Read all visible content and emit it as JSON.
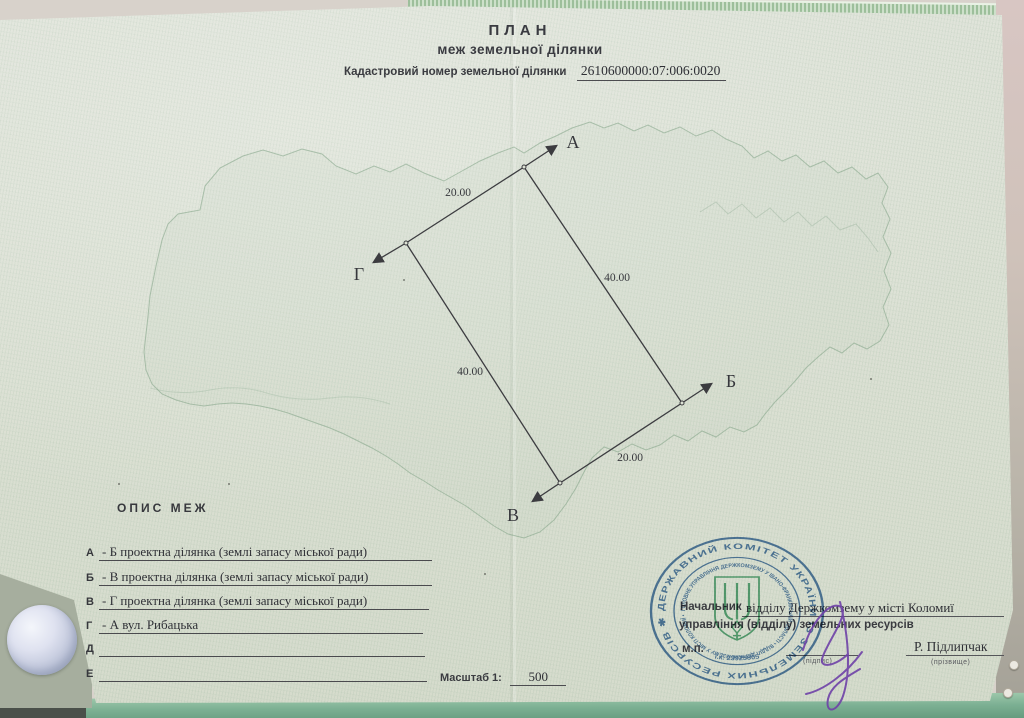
{
  "title": {
    "line1": "ПЛАН",
    "line2": "меж земельної ділянки"
  },
  "cadastral": {
    "label": "Кадастровий номер земельної ділянки",
    "number": "2610600000:07:006:0020"
  },
  "diagram": {
    "corner_a": "А",
    "corner_b": "Б",
    "corner_v": "В",
    "corner_g": "Г",
    "len_ga": "20.00",
    "len_ab": "40.00",
    "len_gv": "40.00",
    "len_vb": "20.00"
  },
  "description": {
    "heading": "ОПИС МЕЖ",
    "rows": [
      {
        "letter": "А",
        "text": "- Б проектна ділянка (землі запасу міської ради)"
      },
      {
        "letter": "Б",
        "text": "- В проектна ділянка (землі запасу міської ради)"
      },
      {
        "letter": "В",
        "text": "- Г проектна ділянка (землі запасу міської ради)"
      },
      {
        "letter": "Г",
        "text": "- А вул. Рибацька"
      },
      {
        "letter": "Д",
        "text": ""
      },
      {
        "letter": "Е",
        "text": ""
      }
    ]
  },
  "scale": {
    "label": "Масштаб 1:",
    "value": "500"
  },
  "approval": {
    "position_label": "Начальник",
    "position_filled": "відділу Держкомзему у місті Коломиї",
    "position_line2": "управління (відділу) земельних ресурсів",
    "seal_abbr": "м.п.",
    "signature_caption": "(підпис)",
    "surname": "Р. Підлипчак",
    "surname_caption": "(прізвище)",
    "ink_color": "#6f42a8"
  },
  "stamp": {
    "outer_text": "ДЕРЖАВНИЙ КОМІТЕТ УКРАЇНИ ІЗ ЗЕМЕЛЬНИХ РЕСУРСІВ ✱",
    "inner_text": "ГОЛОВНЕ УПРАВЛІННЯ ДЕРЖКОМЗЕМУ У ІВАНО-ФРАНКІВСЬКІЙ ОБЛАСТІ • ВІДДІЛ ДЕРЖКОМЗЕМУ У МІСТІ КОЛОМИЇ •",
    "code_text": "і.к. 23925805",
    "ink_color": "#3467a3",
    "trident_color": "#3f9f6a"
  }
}
